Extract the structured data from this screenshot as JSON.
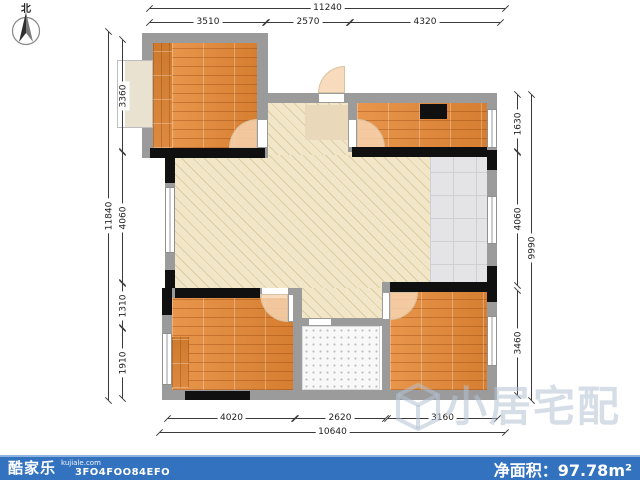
{
  "compass": {
    "label": "北"
  },
  "dimensions": {
    "top": {
      "overall": "11240",
      "segments": [
        "3510",
        "2570",
        "4320"
      ]
    },
    "left": {
      "overall": "11840",
      "segments": [
        "3360",
        "4060",
        "1310",
        "1910"
      ]
    },
    "right": {
      "overall": "9990",
      "segments": [
        "1630",
        "4060",
        "3460"
      ]
    },
    "bottom": {
      "overall": "10640",
      "segments": [
        "4020",
        "2620",
        "3160"
      ]
    }
  },
  "watermark": {
    "text": "小居宅配"
  },
  "footer": {
    "brand": "酷家乐",
    "domain": "kujiale.com",
    "plan_code": "3FO4FOO84EFO",
    "area_label": "净面积：",
    "area_value": "97.78",
    "area_unit": "m²"
  },
  "colors": {
    "wood_floor": "#e08a3e",
    "living_floor": "#f1e6c8",
    "gray_tile": "#e4e4e7",
    "bath_tile": "#f8f8f8",
    "wall_gray": "#9b9b9b",
    "wall_black": "#101010",
    "footer_bar": "#3372bf",
    "watermark": "#b2c1d1"
  }
}
